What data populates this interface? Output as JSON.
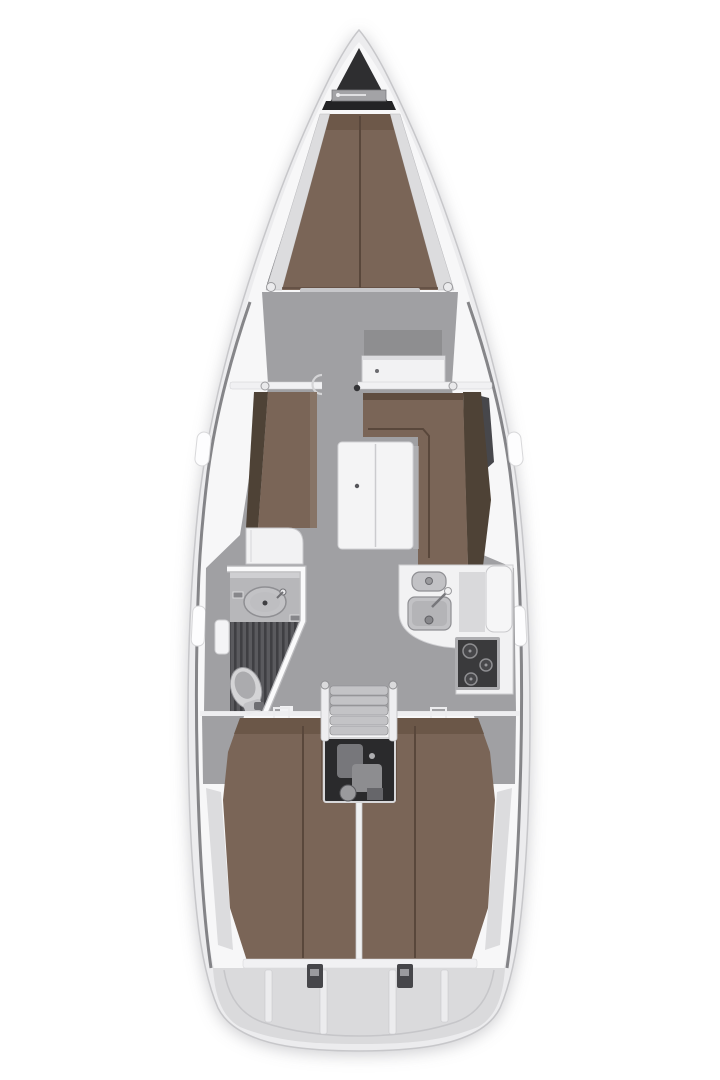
{
  "figure": {
    "name": "sailing-yacht-deck-plan",
    "orientation": "bow-up"
  },
  "regions": [
    "anchor-locker",
    "v-berth",
    "forward-cabin",
    "forward-desk",
    "saloon",
    "port-settee",
    "chart-seat",
    "dinette-settee",
    "saloon-table",
    "heads-with-shower",
    "toilet",
    "vanity-sink",
    "galley",
    "galley-sinks",
    "stove",
    "companionway-steps",
    "engine-compartment",
    "port-aft-cabin-berth",
    "starboard-aft-cabin-berth",
    "transom-lazarette"
  ],
  "colors": {
    "background": "#ffffff",
    "hull_outer": "#ececee",
    "hull_inner": "#f7f7f8",
    "hull_stroke": "#c7c7ca",
    "sheer_shadow": "#606064",
    "floor_gray": "#a0a0a3",
    "berth_brown": "#7a6557",
    "berth_seam": "#59473b",
    "berth_head_shade": "#6b5748",
    "settee_back": "#4e4236",
    "cushion_edge": "#8d7a6c",
    "anchor_dark": "#2e2e30",
    "windlass_gray": "#a3a3a6",
    "locker_band": "#232325",
    "shelf_gray": "#dcdcde",
    "white_furniture": "#f2f2f3",
    "counter_shadow": "#d9d9db",
    "sink_gray": "#c2c2c5",
    "stove_frame": "#aeaeb1",
    "stove_dark": "#3a3a3c",
    "steps_gray": "#c3c3c6",
    "engine_dark": "#2a2a2c",
    "grate_dark": "#5a5a5e",
    "toilet_light": "#d4d4d6",
    "transom_gray": "#dadadc",
    "latch_dark": "#46464a",
    "table_white": "#f4f4f5",
    "desk_shadow": "#8e8e90",
    "dark_wedge": "#47474b",
    "wall_white": "#fafafb",
    "notch_white": "#fdfdfe"
  }
}
